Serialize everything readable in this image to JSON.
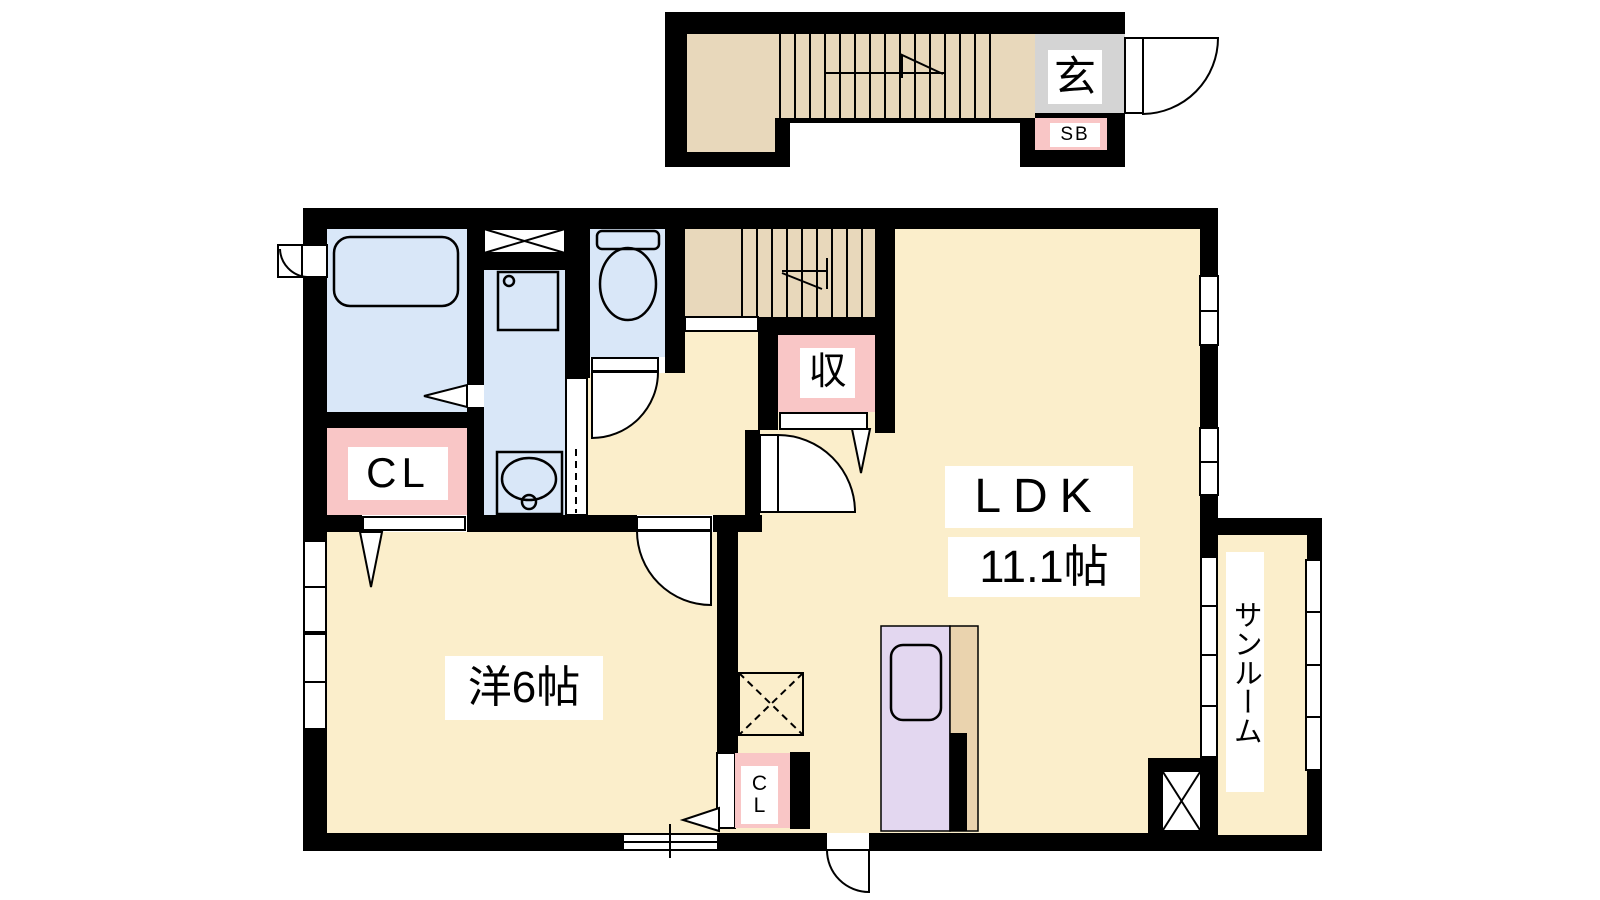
{
  "plan": {
    "title": "1LDK apartment floor plan (2F)",
    "labels": {
      "entrance": "玄",
      "shoe_box": "SB",
      "storage": "収",
      "closet": "CL",
      "closet_c": "C",
      "closet_l": "L",
      "ldk": "LDK",
      "ldk_size": "11.1帖",
      "western_room": "洋6帖",
      "sunroom": "サンルーム"
    },
    "colors": {
      "wall": "#000000",
      "floor": "#FBEECB",
      "stairs": "#E8D8BB",
      "wet_area": "#D9E7F8",
      "closet_pink": "#F9C6C6",
      "entrance_grey": "#D4D4D4",
      "kitchen_purple": "#E3D7F0",
      "counter_tan": "#EAD3AE"
    }
  }
}
